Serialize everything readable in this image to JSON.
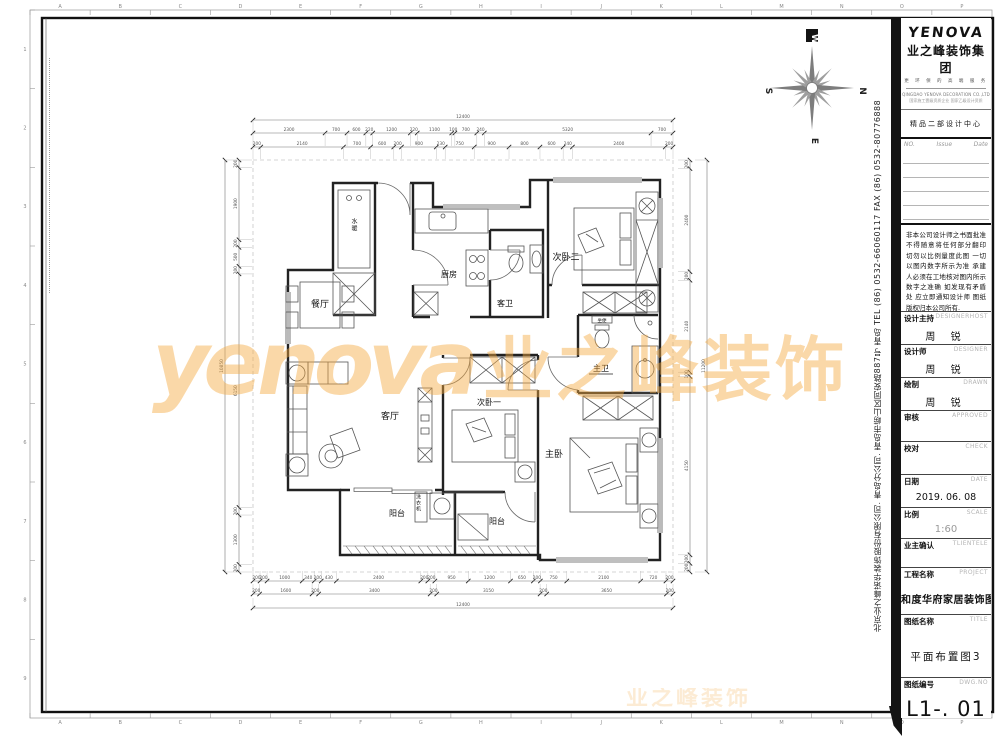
{
  "sheet": {
    "ruler_letters": [
      "A",
      "B",
      "C",
      "D",
      "E",
      "F",
      "G",
      "H",
      "I",
      "J",
      "K",
      "L",
      "M",
      "N",
      "O",
      "P"
    ],
    "ruler_numbers": [
      "1",
      "2",
      "3",
      "4",
      "5",
      "6",
      "7",
      "8",
      "9"
    ]
  },
  "compass": {
    "top": "W",
    "right": "N",
    "bottom": "E",
    "left": "S"
  },
  "watermark": {
    "latin": "yenova",
    "cn": "业之峰装饰",
    "small": "业之峰装饰"
  },
  "plan": {
    "labels": {
      "water_heater": "水暖",
      "dining": "餐厅",
      "kitchen": "厨房",
      "guest_bath": "客卫",
      "bedroom2": "次卧二",
      "master_bath": "主卫",
      "toilet_seat": "坐便",
      "living": "客厅",
      "bedroom1": "次卧一",
      "master_bedroom": "主卧",
      "balcony1": "阳台",
      "balcony2": "阳台",
      "washer": "洗衣机"
    },
    "dims": {
      "top_total": [
        "12400"
      ],
      "top_mid": [
        "2300",
        "700",
        "600",
        "220",
        "1200",
        "220",
        "1100",
        "100",
        "700",
        "240",
        "5320",
        "700"
      ],
      "top_inner": [
        "200",
        "2140",
        "700",
        "600",
        "200",
        "900",
        "230",
        "750",
        "900",
        "800",
        "600",
        "240",
        "2400",
        "200"
      ],
      "bottom_inner": [
        "200",
        "200",
        "1000",
        "340",
        "200",
        "430",
        "2400",
        "200",
        "200",
        "950",
        "1200",
        "650",
        "200",
        "750",
        "2100",
        "720",
        "200"
      ],
      "bottom_mid": [
        "200",
        "1600",
        "200",
        "3400",
        "200",
        "3150",
        "200",
        "3650",
        "200"
      ],
      "bottom_total": [
        "12400"
      ],
      "left_inner": [
        "200",
        "1900",
        "200",
        "500",
        "200",
        "6150",
        "200",
        "1300",
        "200"
      ],
      "left_total": [
        "10850"
      ],
      "right_inner": [
        "200",
        "2400",
        "200",
        "2140",
        "100",
        "4150",
        "200",
        "200"
      ],
      "right_total": [
        "11200"
      ]
    }
  },
  "titleblock": {
    "logo": {
      "brand": "YENOVA",
      "company_cn": "业之峰装饰集团",
      "tagline": "更 环 保 的 高 端 服 务",
      "company_en": "QINGDAO YENOVA DECORATION CO.,LTD",
      "cert": "国家施工壹级资质企业 国家乙级设计资质"
    },
    "dept": "精品二部设计中心",
    "issue": {
      "no": "NO.",
      "issue": "Issue",
      "date": "Date"
    },
    "disclaimer": "非本公司设计师之书面批准不得随意将任何部分翻印 切勿以比例量度此图 一切以图内数字所示为准 承建人必须在工地核对图内所示数字之准确 如发现有矛盾处 应立即通知设计师 图纸版权归本公司所有.",
    "fields": [
      {
        "label": "设计主持",
        "en": "DESIGNERHOST",
        "value": "周 锐"
      },
      {
        "label": "设计师",
        "en": "DESIGNER",
        "value": "周 锐"
      },
      {
        "label": "绘制",
        "en": "DRAWN",
        "value": "周 锐"
      },
      {
        "label": "审核",
        "en": "APPROVED",
        "value": ""
      },
      {
        "label": "校对",
        "en": "CHECK",
        "value": ""
      },
      {
        "label": "日期",
        "en": "DATE",
        "value": "2019. 06. 08"
      },
      {
        "label": "比例",
        "en": "SCALE",
        "value": "1:60"
      },
      {
        "label": "业主确认",
        "en": "TLIENTELE",
        "value": ""
      },
      {
        "label": "工程名称",
        "en": "PROJECT",
        "value": "和度华府家居装饰图"
      },
      {
        "label": "图纸名称",
        "en": "TITLE",
        "value": "平面布置图3"
      },
      {
        "label": "图纸编号",
        "en": "DWG.NO",
        "value": "L1-. 01"
      }
    ],
    "side_text": "北京业之峰诺华装饰股份有限公司. 青岛分公司. 青岛市崂山区同安路887号  青岛  TEL (86) 0532-66060117  FAX (86) 0532-80776888"
  }
}
